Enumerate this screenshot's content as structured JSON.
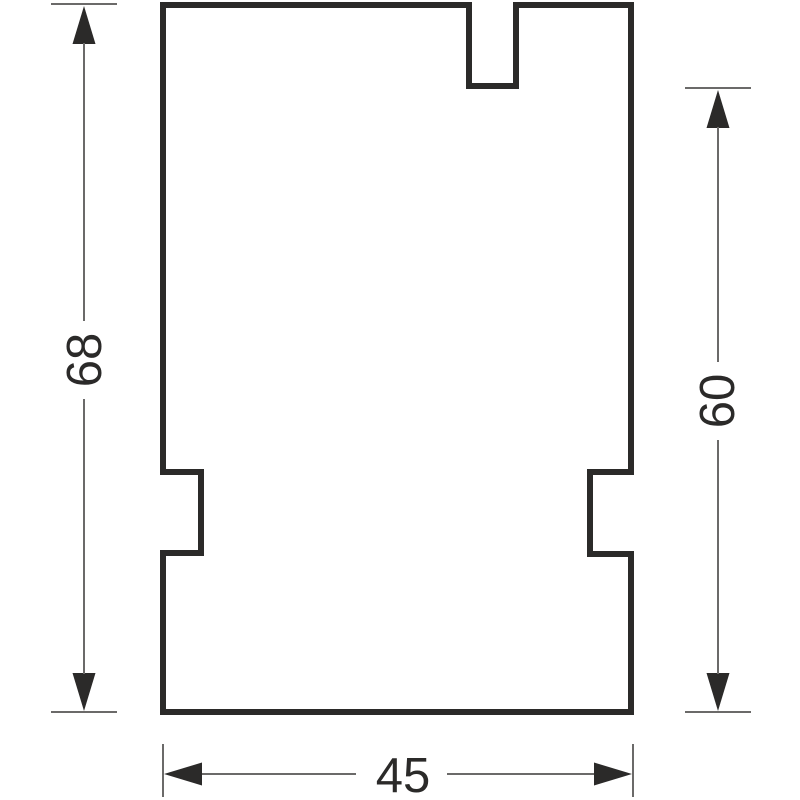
{
  "drawing": {
    "type": "technical-cross-section-profile",
    "dimensions": {
      "left_height": {
        "label": "68"
      },
      "right_height": {
        "label": "60"
      },
      "bottom_width": {
        "label": "45"
      }
    },
    "colors": {
      "background": "#ffffff",
      "outline": "#2b2a29",
      "dimension_line": "#6b6a69",
      "arrow": "#2b2a29",
      "text": "#2b2a29"
    }
  }
}
